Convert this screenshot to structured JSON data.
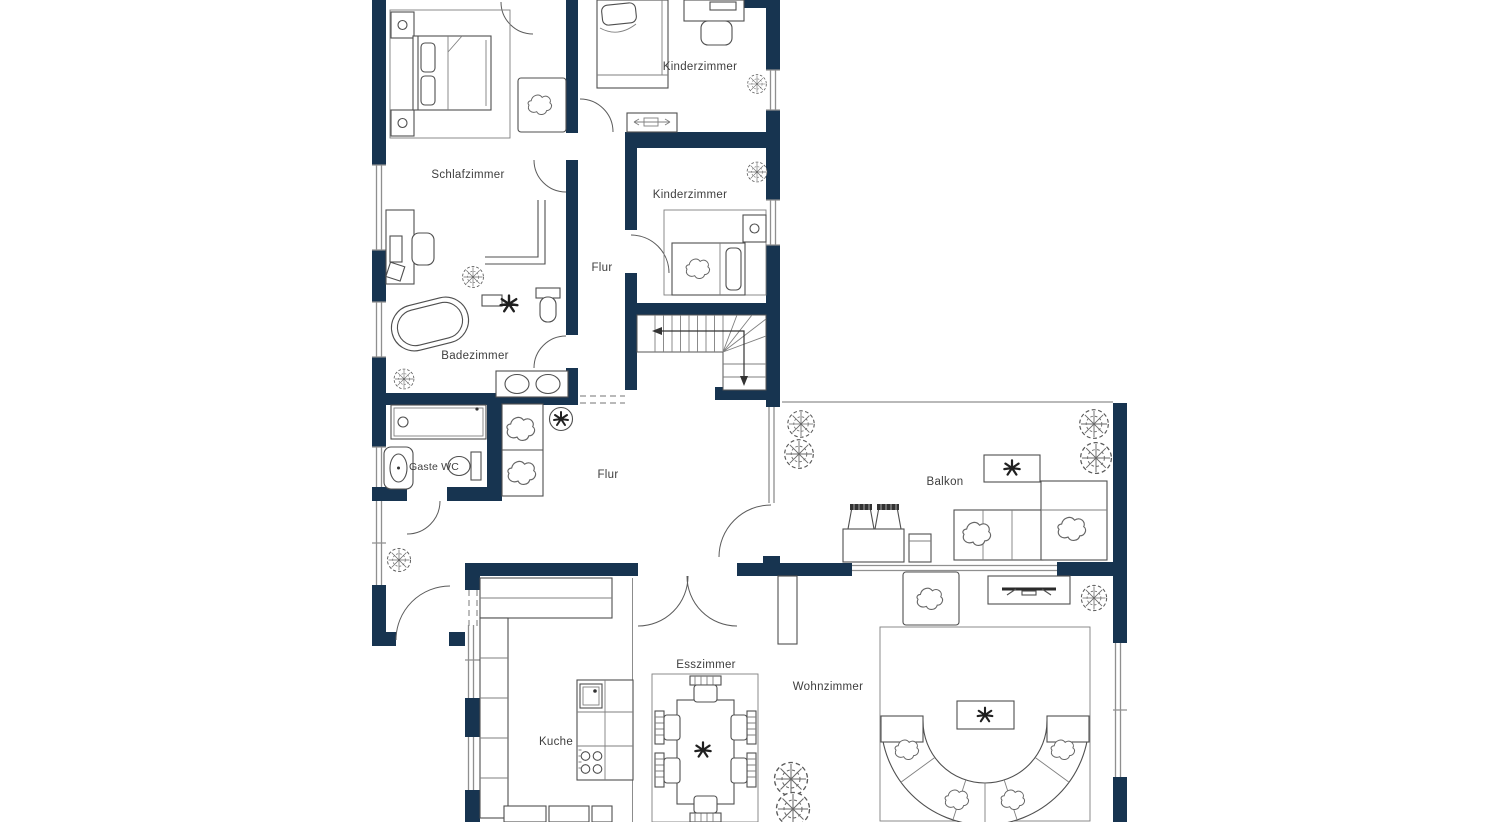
{
  "floorplan": {
    "type": "apartment-floorplan",
    "rooms": {
      "schlafzimmer": {
        "label": "Schlafzimmer"
      },
      "kinderzimmer1": {
        "label": "Kinderzimmer"
      },
      "kinderzimmer2": {
        "label": "Kinderzimmer"
      },
      "flur1": {
        "label": "Flur"
      },
      "flur2": {
        "label": "Flur"
      },
      "badezimmer": {
        "label": "Badezimmer"
      },
      "gaeste_wc": {
        "label": "Gaste WC"
      },
      "balkon": {
        "label": "Balkon"
      },
      "esszimmer": {
        "label": "Esszimmer"
      },
      "wohnzimmer": {
        "label": "Wohnzimmer"
      },
      "kueche": {
        "label": "Kuche"
      }
    },
    "colors": {
      "wall": "#173450",
      "background": "#ffffff",
      "furniture_stroke": "#4f4f4f",
      "window_line": "#8f8f8f",
      "label_text": "#3e3e3e"
    }
  }
}
